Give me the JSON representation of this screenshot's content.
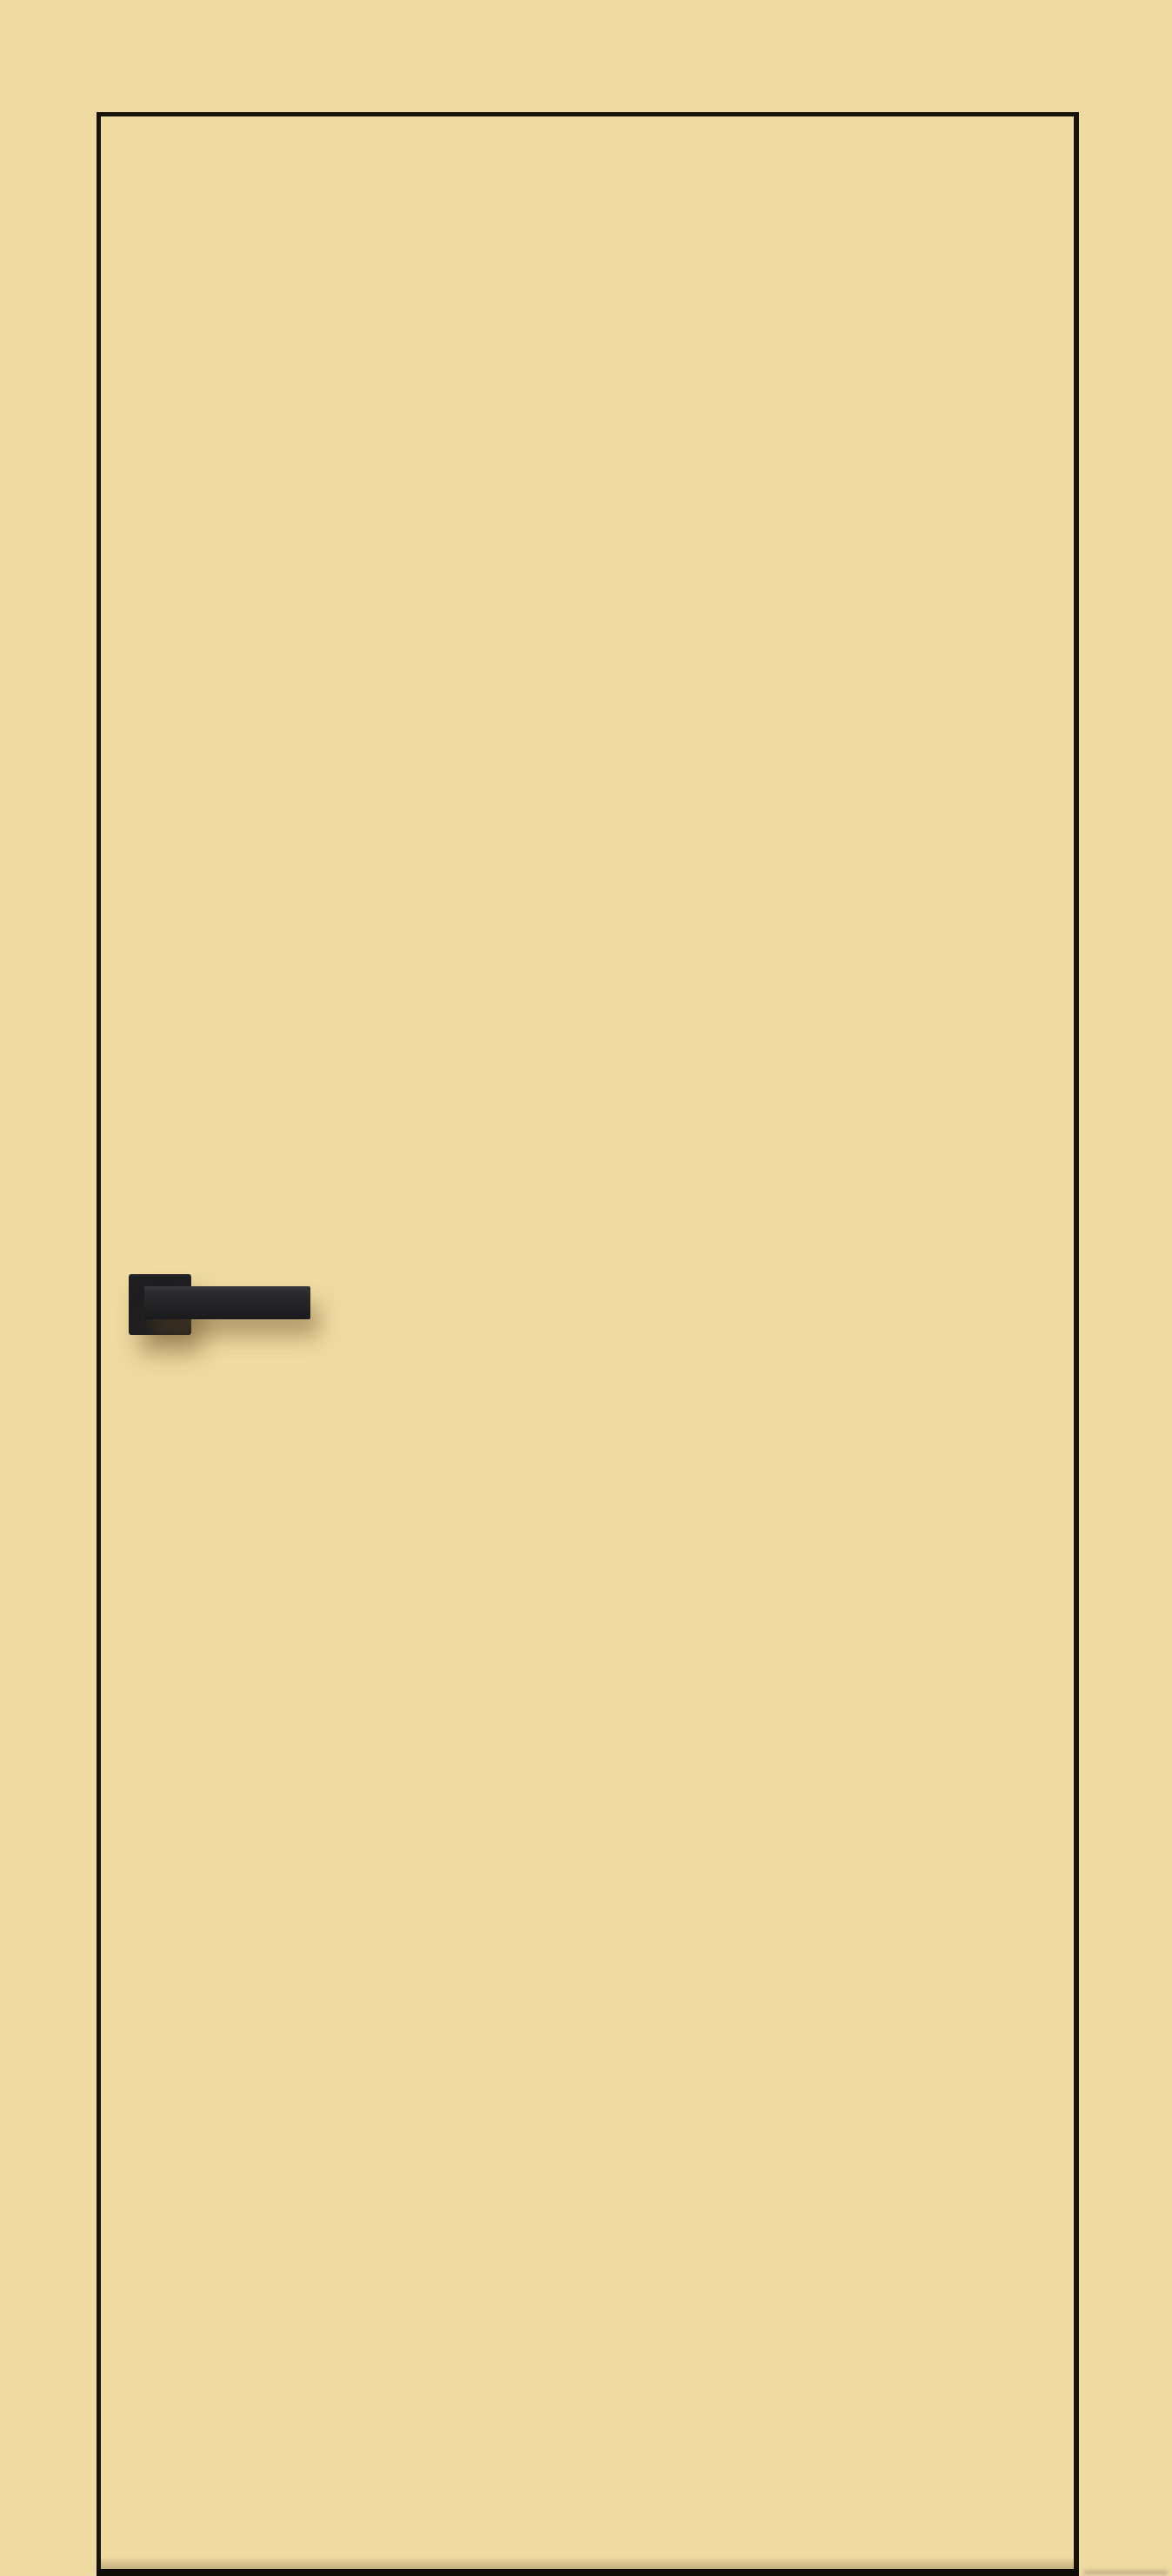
{
  "image": {
    "alt": "Beige flush interior door leaf with thin black edge outline and matte black lever handle",
    "description": "Product photo of a flush interior door leaf in a cream-beige finish, outlined by a thin black edge line, with a matte black square-rosette straight lever handle mounted on the left side and a dark gap visible under the door at the floor."
  },
  "door": {
    "finish": "cream-beige",
    "edge_style": "thin black edge outline",
    "handle_style": "square-rosette straight lever, matte black"
  },
  "colors": {
    "background": "#efdaa2",
    "door_fill": "#efdaa2",
    "edge_line": "#181309",
    "threshold": "#0f0c08",
    "handle_rosette": "#1e1e20",
    "handle_lever": "#242427",
    "handle_highlight": "#3a3a3d",
    "shadow": "rgba(97,75,35,0.42)"
  }
}
